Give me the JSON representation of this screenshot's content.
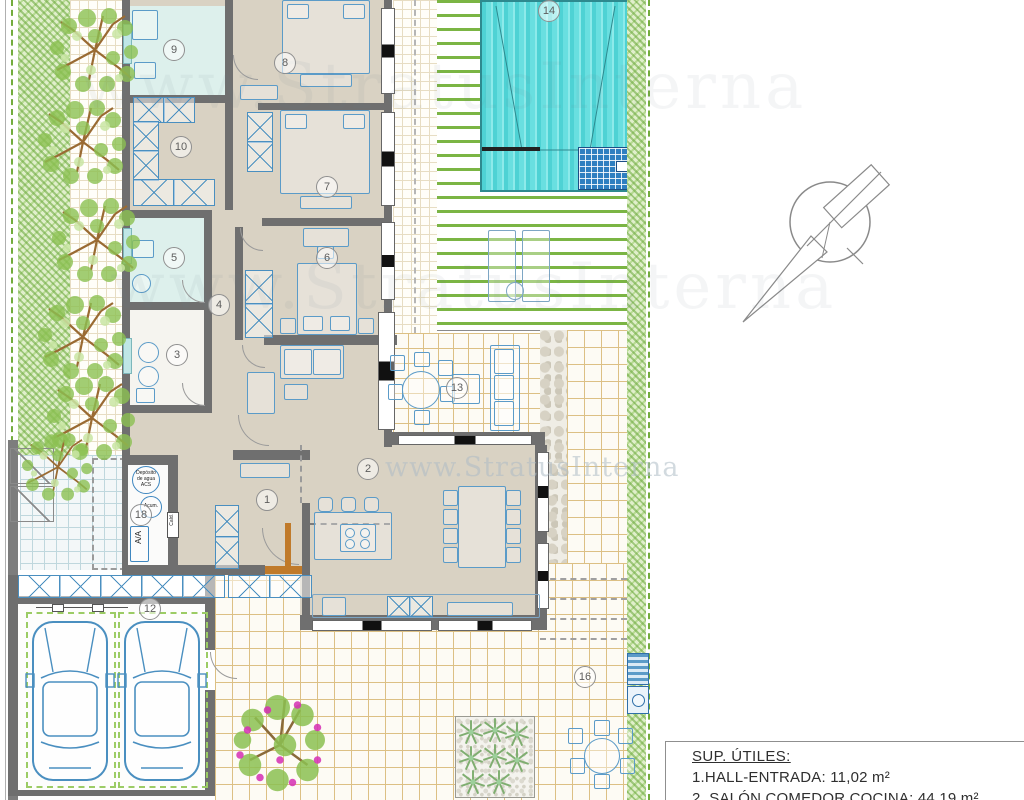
{
  "plan": {
    "labels": {
      "1": "1",
      "2": "2",
      "3": "3",
      "4": "4",
      "5": "5",
      "6": "6",
      "7": "7",
      "8": "8",
      "9": "9",
      "10": "10",
      "12": "12",
      "13": "13",
      "14": "14",
      "16": "16",
      "18": "18"
    },
    "rooms_named": [
      {
        "number": "1",
        "name": "Hall-Entrada"
      },
      {
        "number": "2",
        "name": "Salón Comedor Cocina"
      }
    ],
    "legend": {
      "title": "SUP. ÚTILES:",
      "items": [
        "1.HALL-ENTRADA: 11,02 m²",
        "2. SALÓN COMEDOR COCINA: 44,19 m²"
      ]
    },
    "watermark": {
      "url": "www.StratusInterna"
    },
    "equipment": {
      "ac": "A/A",
      "boiler": "Cald.",
      "accumulator": "Acum.",
      "tank_l1": "Depósito",
      "tank_l2": "de agua",
      "tank_l3": "ACS"
    },
    "colors": {
      "wall": "#6f6f6f",
      "floor": "#d9d2c3",
      "pool": "#4ed2d4",
      "deck_slat": "#7bb544",
      "furniture": "#5b9bc8",
      "hedge": "#68a63a",
      "tile_line": "#dcc084",
      "door_wood": "#c07a2a"
    }
  }
}
